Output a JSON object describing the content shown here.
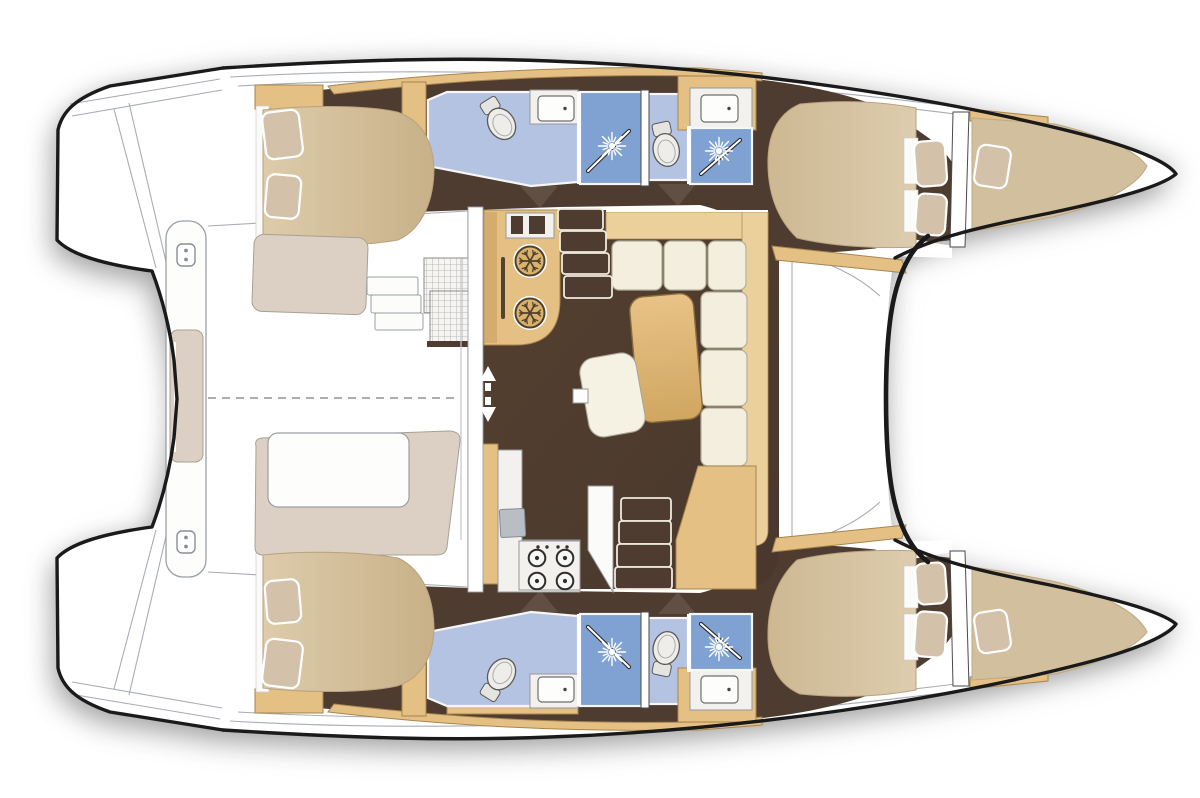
{
  "meta": {
    "width": 1200,
    "height": 798
  },
  "vessel": {
    "type": "catamaran",
    "view": "top-down-interior-layout",
    "cabins": 4,
    "heads": 4,
    "showers": 4,
    "forepeak_berths": 2
  },
  "rooms": [
    {
      "id": "saloon",
      "label": "saloon"
    },
    {
      "id": "galley-port",
      "label": "galley port side"
    },
    {
      "id": "galley-starboard",
      "label": "galley starboard side"
    },
    {
      "id": "aft-cockpit",
      "label": "aft cockpit"
    },
    {
      "id": "port-aft-cabin",
      "label": "port aft cabin"
    },
    {
      "id": "port-forward-cabin",
      "label": "port forward cabin"
    },
    {
      "id": "starboard-aft-cabin",
      "label": "starboard aft cabin"
    },
    {
      "id": "starboard-forward-cabin",
      "label": "starboard forward cabin"
    },
    {
      "id": "port-aft-head",
      "label": "port aft head"
    },
    {
      "id": "port-forward-head",
      "label": "port forward head"
    },
    {
      "id": "starboard-aft-head",
      "label": "starboard aft head"
    },
    {
      "id": "starboard-forward-head",
      "label": "starboard forward head"
    },
    {
      "id": "port-forepeak-berth",
      "label": "port forepeak berth"
    },
    {
      "id": "starboard-forepeak-berth",
      "label": "starboard forepeak berth"
    }
  ],
  "colors": {
    "page_bg": "#ffffff",
    "outline": "#1a1a1a",
    "deck_line": "#a8adb3",
    "floor": "#4e3c31",
    "wood": "#e5c084",
    "wood_dark": "#a8854e",
    "wood_light": "#ecd09b",
    "cream": "#f4eede",
    "cream_stroke": "#b3ae9c",
    "bed": "#d8c5a4",
    "bed_dark": "#c6af87",
    "pillow": "#d4c1aa",
    "beige": "#dbd0c3",
    "bath_floor": "#b4c3e2",
    "bath_shower": "#7fa2d3",
    "sink_gray": "#b9bec4"
  },
  "fixtures": {
    "shower_heads": [
      {
        "x": 612,
        "y": 146
      },
      {
        "x": 719,
        "y": 151
      },
      {
        "x": 612,
        "y": 652
      },
      {
        "x": 719,
        "y": 647
      }
    ],
    "toilets": [
      {
        "x": 501,
        "y": 123,
        "rot": -32
      },
      {
        "x": 666,
        "y": 149,
        "rot": -12
      },
      {
        "x": 501,
        "y": 675,
        "rot": 212
      },
      {
        "x": 666,
        "y": 649,
        "rot": 192
      }
    ],
    "sinks": [
      {
        "x": 538,
        "y": 96,
        "w": 36,
        "h": 25
      },
      {
        "x": 701,
        "y": 95,
        "w": 37,
        "h": 27
      },
      {
        "x": 538,
        "y": 677,
        "w": 36,
        "h": 25
      },
      {
        "x": 701,
        "y": 676,
        "w": 37,
        "h": 27
      }
    ],
    "glass_doors": [
      {
        "x1": 588,
        "y1": 171,
        "x2": 629,
        "y2": 131
      },
      {
        "x1": 701,
        "y1": 174,
        "x2": 740,
        "y2": 140
      },
      {
        "x1": 588,
        "y1": 627,
        "x2": 629,
        "y2": 667
      },
      {
        "x1": 701,
        "y1": 624,
        "x2": 740,
        "y2": 658
      }
    ],
    "fridges": [
      {
        "x": 530,
        "y": 261
      },
      {
        "x": 530,
        "y": 313
      }
    ],
    "burners": [
      {
        "x": 537,
        "y": 558
      },
      {
        "x": 565,
        "y": 558
      },
      {
        "x": 537,
        "y": 581
      },
      {
        "x": 565,
        "y": 581
      }
    ],
    "stove_knobs": [
      {
        "x": 538,
        "y": 547
      },
      {
        "x": 547,
        "y": 547
      },
      {
        "x": 558,
        "y": 547
      },
      {
        "x": 567,
        "y": 547
      }
    ],
    "cleats": [
      {
        "x": 186,
        "y": 255
      },
      {
        "x": 186,
        "y": 542
      }
    ],
    "pillows": [
      {
        "room": "port-aft-cabin",
        "x": 264,
        "y": 111,
        "w": 37,
        "h": 47,
        "rot": -7
      },
      {
        "room": "port-aft-cabin",
        "x": 266,
        "y": 175,
        "w": 34,
        "h": 43,
        "rot": 5
      },
      {
        "room": "starboard-aft-cabin",
        "x": 264,
        "y": 640,
        "w": 37,
        "h": 47,
        "rot": 7
      },
      {
        "room": "starboard-aft-cabin",
        "x": 266,
        "y": 580,
        "w": 34,
        "h": 43,
        "rot": -5
      },
      {
        "room": "port-forward-cabin",
        "x": 915,
        "y": 141,
        "w": 31,
        "h": 45,
        "rot": -4
      },
      {
        "room": "port-forward-cabin",
        "x": 916,
        "y": 194,
        "w": 30,
        "h": 41,
        "rot": 4
      },
      {
        "room": "starboard-forward-cabin",
        "x": 915,
        "y": 612,
        "w": 31,
        "h": 45,
        "rot": 4
      },
      {
        "room": "starboard-forward-cabin",
        "x": 916,
        "y": 563,
        "w": 30,
        "h": 41,
        "rot": -4
      },
      {
        "room": "port-forepeak-berth",
        "x": 976,
        "y": 146,
        "w": 33,
        "h": 41,
        "rot": 9
      },
      {
        "room": "starboard-forepeak-berth",
        "x": 976,
        "y": 611,
        "w": 33,
        "h": 41,
        "rot": -9
      }
    ],
    "steps": {
      "port_companionway": [
        {
          "x": 558,
          "y": 209,
          "w": 45,
          "h": 21
        },
        {
          "x": 560,
          "y": 231,
          "w": 46,
          "h": 21
        },
        {
          "x": 562,
          "y": 253,
          "w": 47,
          "h": 21
        },
        {
          "x": 564,
          "y": 276,
          "w": 48,
          "h": 22
        }
      ],
      "starboard_companionway": [
        {
          "x": 621,
          "y": 498,
          "w": 50,
          "h": 23
        },
        {
          "x": 619,
          "y": 521,
          "w": 52,
          "h": 23
        },
        {
          "x": 617,
          "y": 544,
          "w": 54,
          "h": 23
        },
        {
          "x": 615,
          "y": 567,
          "w": 57,
          "h": 22
        }
      ],
      "cockpit_side_steps": [
        {
          "x": 367,
          "y": 277,
          "w": 51,
          "h": 18
        },
        {
          "x": 371,
          "y": 295,
          "w": 50,
          "h": 18
        },
        {
          "x": 375,
          "y": 313,
          "w": 48,
          "h": 17
        }
      ]
    }
  }
}
